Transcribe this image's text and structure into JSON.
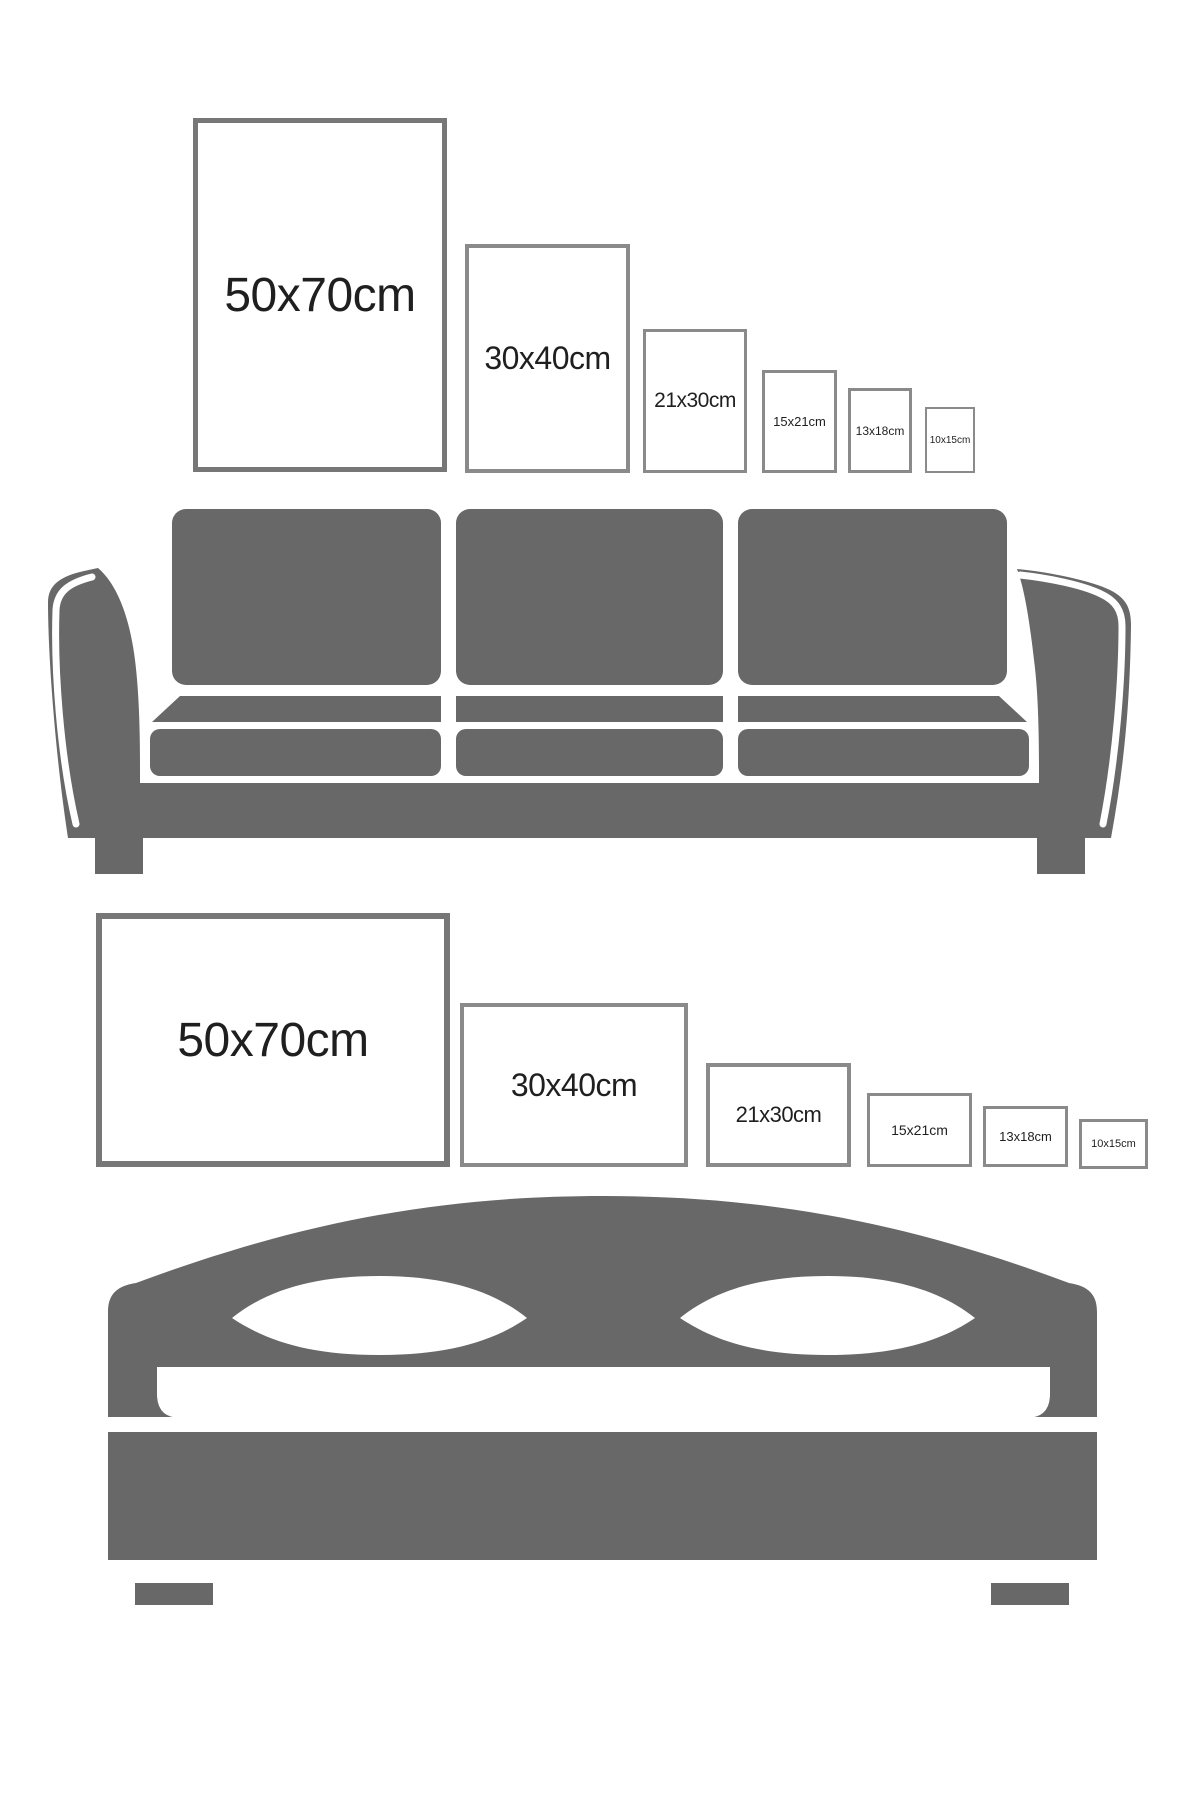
{
  "title": "Poster frame size guide over sofa and bed",
  "colors": {
    "background": "#ffffff",
    "furniture_gray": "#686868",
    "frame_border_large": "#777777",
    "frame_border_small": "#8a8a8a",
    "label_text": "#1f1f1f"
  },
  "size_guide": {
    "sofa_row": {
      "orientation": "portrait",
      "frames": [
        {
          "label": "50x70cm"
        },
        {
          "label": "30x40cm"
        },
        {
          "label": "21x30cm"
        },
        {
          "label": "15x21cm"
        },
        {
          "label": "13x18cm"
        },
        {
          "label": "10x15cm"
        }
      ]
    },
    "bed_row": {
      "orientation": "landscape",
      "frames": [
        {
          "label": "50x70cm"
        },
        {
          "label": "30x40cm"
        },
        {
          "label": "21x30cm"
        },
        {
          "label": "15x21cm"
        },
        {
          "label": "13x18cm"
        },
        {
          "label": "10x15cm"
        }
      ]
    }
  },
  "illustrations": {
    "sofa": {
      "name": "sofa-silhouette-icon"
    },
    "bed": {
      "name": "bed-silhouette-icon"
    }
  }
}
